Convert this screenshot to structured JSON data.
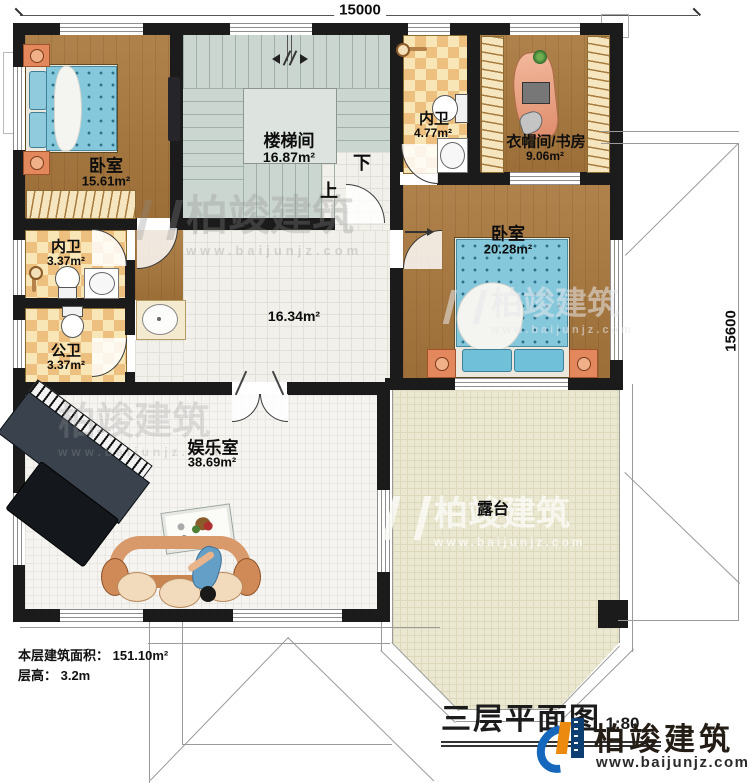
{
  "plan": {
    "title": "三层平面图",
    "scale": "1:80",
    "dim_top": "15000",
    "dim_right": "15600",
    "stairs": {
      "up": "上",
      "down": "下"
    },
    "hall_area": "16.34m²",
    "rooms": {
      "bedroom_tl": {
        "name": "卧室",
        "area": "15.61m²"
      },
      "stairwell": {
        "name": "楼梯间",
        "area": "16.87m²"
      },
      "bath_inner_left": {
        "name": "内卫",
        "area": "3.37m²"
      },
      "bath_public": {
        "name": "公卫",
        "area": "3.37m²"
      },
      "bath_inner_top": {
        "name": "内卫",
        "area": "4.77m²"
      },
      "cloak_study": {
        "name": "衣帽间/书房",
        "area": "9.06m²"
      },
      "bedroom_right": {
        "name": "卧室",
        "area": "20.28m²"
      },
      "recreation": {
        "name": "娱乐室",
        "area": "38.69m²"
      },
      "terrace": {
        "name": "露台"
      }
    },
    "floor_info": {
      "line1": "本层建筑面积： 151.10m²",
      "line2": "层高： 3.2m"
    }
  },
  "brand": {
    "name": "柏竣建筑",
    "url": "www.baijunjz.com"
  },
  "colors": {
    "wall": "#1b1b1b",
    "wood_floor": "#a9773c",
    "bathroom_checker": "#eec07f",
    "stair_floor": "#ccd6d0",
    "terrace_floor": "#ebe8d1",
    "bed_blue": "#85c8dc",
    "logo_blue": "#1668bc",
    "logo_navy": "#0c3e72",
    "logo_orange": "#ec8a10"
  }
}
